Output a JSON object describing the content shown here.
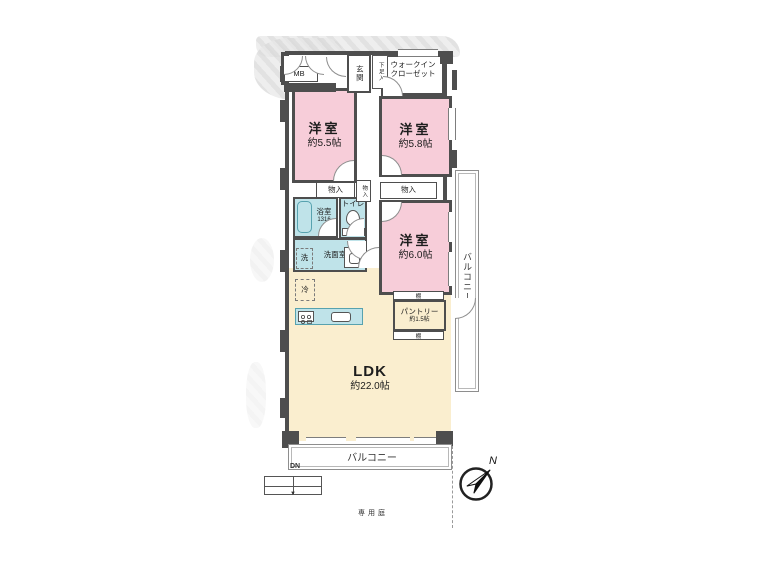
{
  "colors": {
    "pink": "#f7cdd9",
    "cream": "#faeecf",
    "teal": "#bfe3e9",
    "wall": "#4e4e4e",
    "outline": "#8a8a8a",
    "texture": "#d9d9d9"
  },
  "plan": {
    "rooms": {
      "bedroom1": {
        "label": "洋室",
        "size": "約5.5帖"
      },
      "bedroom2": {
        "label": "洋室",
        "size": "約5.8帖"
      },
      "bedroom3": {
        "label": "洋室",
        "size": "約6.0帖"
      },
      "ldk": {
        "label": "LDK",
        "size": "約22.0帖"
      },
      "pantry": {
        "label": "パントリー",
        "size": "約1.5帖"
      },
      "wic": {
        "line1": "ウォークイン",
        "line2": "クローゼット"
      },
      "entrance": {
        "label": "玄関"
      },
      "shoe_box": {
        "label": "下足入"
      },
      "bathroom": {
        "label": "浴室",
        "size": "1316"
      },
      "toilet": {
        "label": "トイレ"
      },
      "toilet_shelf": {
        "label": "棚"
      },
      "washroom": {
        "label": "洗面室"
      },
      "washer": {
        "label": "洗"
      },
      "fridge": {
        "label": "冷"
      },
      "meter_box": {
        "label": "MB"
      },
      "closet_a": {
        "label": "物入"
      },
      "closet_b": {
        "label": "物入"
      },
      "closet_c": {
        "label": "物入"
      },
      "shelf_top": {
        "label": "棚"
      },
      "shelf_bottom": {
        "label": "棚"
      },
      "balcony_right": {
        "label": "バルコニー"
      },
      "balcony_bottom": {
        "label": "バルコニー"
      },
      "stairs": {
        "label": "DN"
      },
      "garden": {
        "label": "専用庭"
      }
    },
    "compass": {
      "label": "N"
    }
  }
}
